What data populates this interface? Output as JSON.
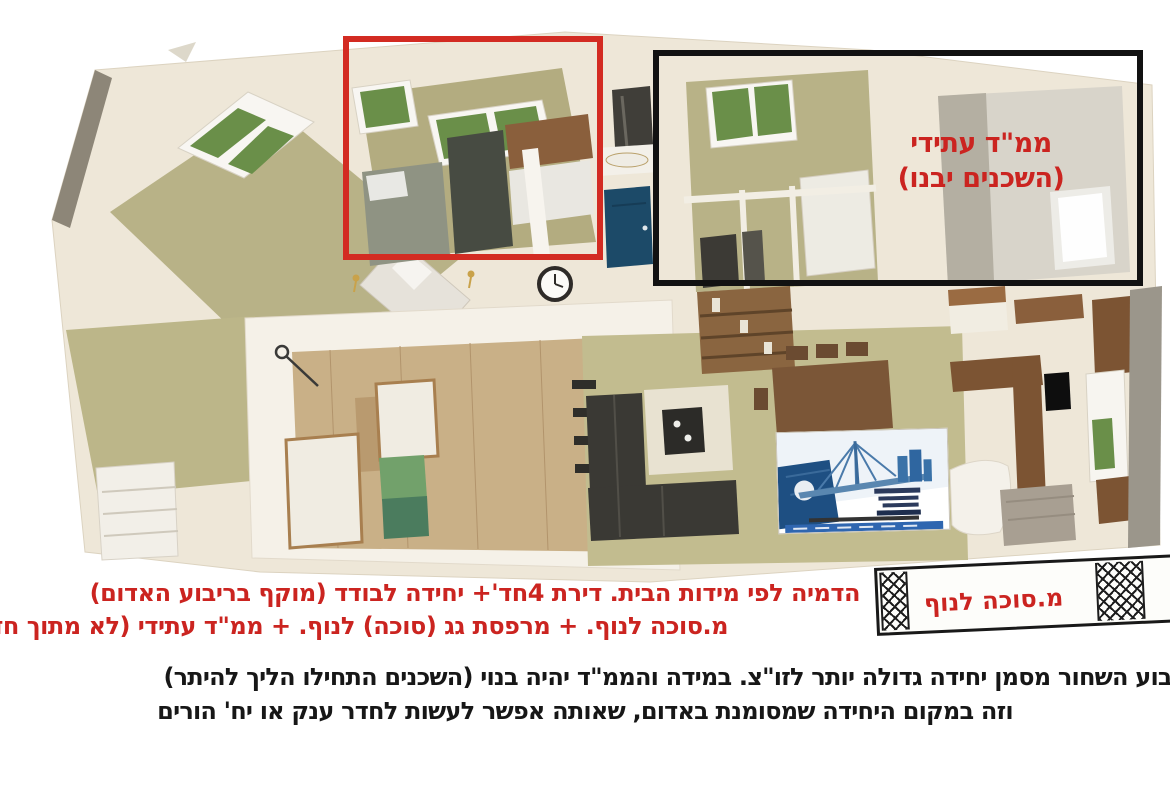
{
  "scene": {
    "type": "3d-apartment-floor-plan-render",
    "background": "#ffffff"
  },
  "colors": {
    "annotation_red": "#cb2420",
    "annotation_black": "#121212",
    "wall_cream": "#eee7d8",
    "floor_olive": "#b8b287",
    "caption_text_black": "#171717"
  },
  "annotations": {
    "mamad_line1": "ממ\"ד עתידי",
    "mamad_line2": "(השכנים יבנו)",
    "sukkah_label": "מ.סוכה לנוף"
  },
  "captions": {
    "red_line1": "הדמיה לפי מידות הבית. דירת 4חד'+ יחידה לבודד (מוקף בריבוע האדום)",
    "red_line2": "מ.סוכה לנוף. + מרפסת גג (סוכה) לנוף. + ממ\"ד עתידי (לא מתוך חדר)",
    "black_line1": "יבוע השחור מסמן יחידה גדולה יותר לזו\"צ. במידה והממ\"ד יהיה בנוי (השכנים התחילו הליך להיתר)",
    "black_line2": "וזה במקום היחידה שמסומנת באדום, שאותה אפשר לעשות לחדר ענק או יח' הורים"
  }
}
